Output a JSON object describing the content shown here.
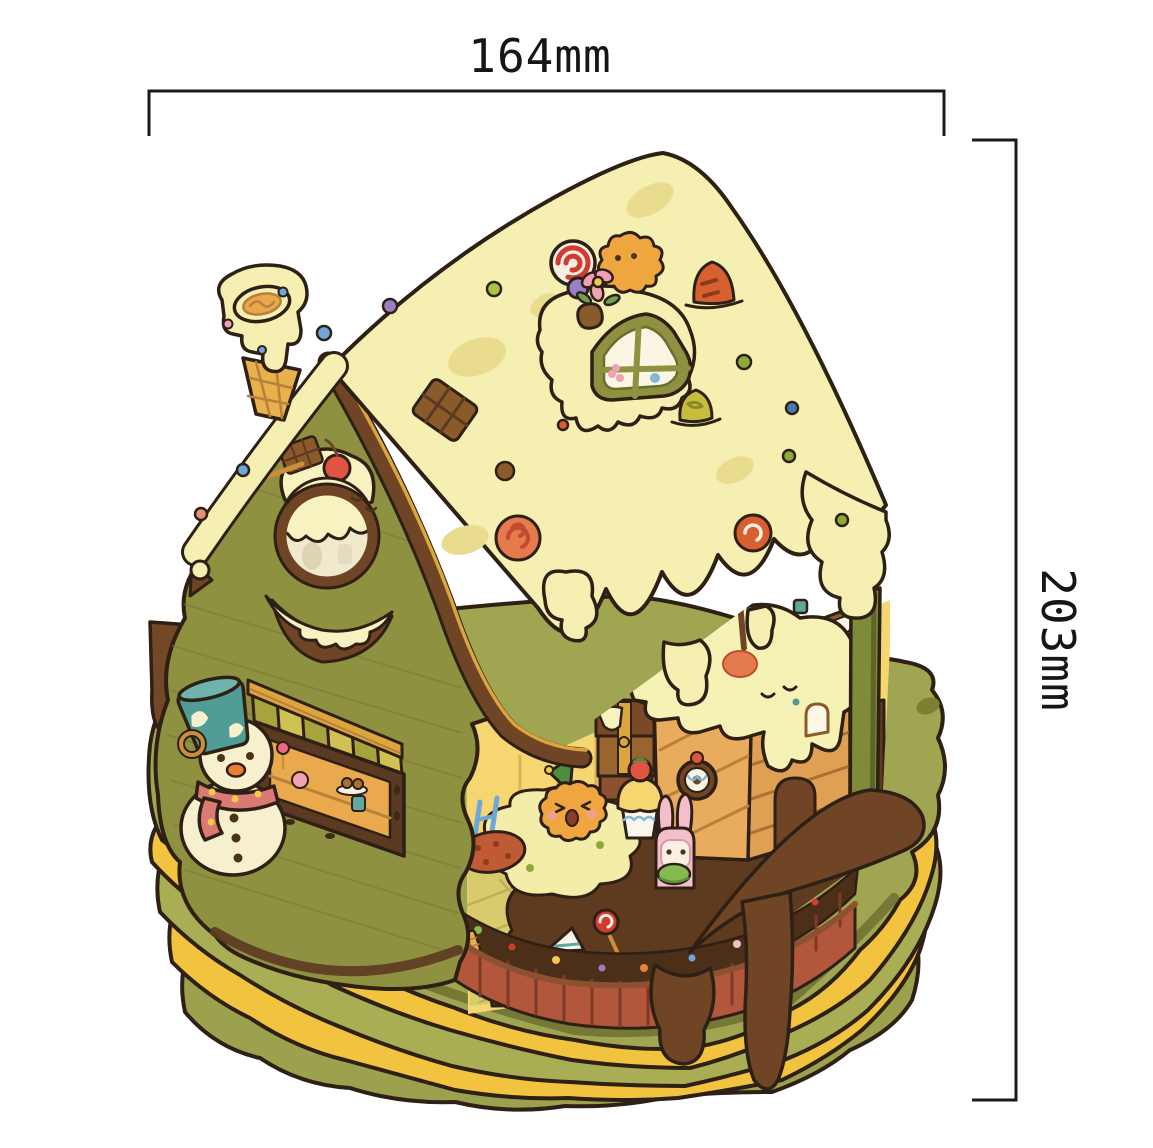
{
  "annotations": {
    "width": {
      "label": "164mm"
    },
    "height": {
      "label": "203mm"
    }
  },
  "palette": {
    "background": "#ffffff",
    "dimension_line": "#1a1a1a",
    "outline": "#2e2014",
    "roof_icing": "#f5efb2",
    "icing_cream": "#f7f2c0",
    "icing_patch": "#eadc8f",
    "wall_olive": "#8e9140",
    "trim_brown": "#6f4526",
    "trim_gold": "#dda53e",
    "under_roof_orange": "#f0a845",
    "fascia_yellow": "#f3c94f",
    "interior_wall": "#f5d671",
    "floor_tile": "#d8cb6e",
    "chocolate": "#5e3a1e",
    "chocolate_drip": "#6f4526",
    "base_olive": "#a0a552",
    "base_olive_mid": "#a9ae55",
    "base_olive_dark": "#9ba14c",
    "base_yellow": "#f2c33f",
    "brick_fence": "#b2573b",
    "soil": "#4c2f18",
    "kennel_wood": "#dfa054",
    "snowman_body": "#f6f0ce",
    "bucket_teal": "#4f9d96",
    "scarf_pink": "#db7a72",
    "cherry_red": "#e25442",
    "bunny_pink": "#f4bfcb",
    "cookie_orange": "#f0a63f",
    "post_green": "#7e8c3a"
  }
}
